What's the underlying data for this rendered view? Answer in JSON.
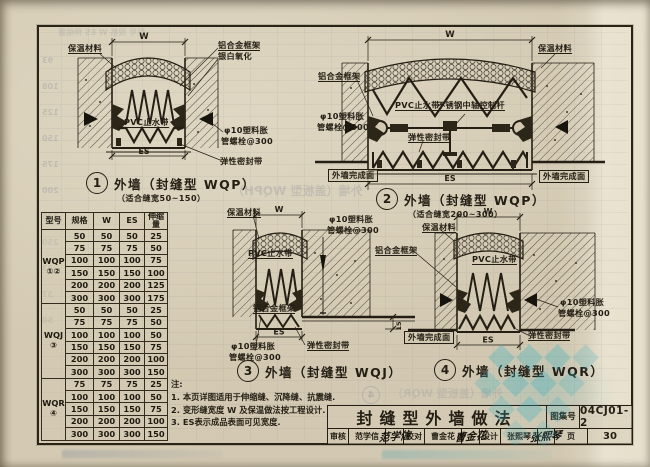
{
  "labels": {
    "insulation": "保温材料",
    "alu_frame": "铝合金框架",
    "anodized": "银白氧化",
    "pvc": "PVC止水带",
    "bolt1": "φ10塑料胀",
    "bolt2": "管螺栓@300",
    "seal": "弹性密封带",
    "rod": "不锈钢中轴控制杆",
    "finish": "外墙完成面",
    "w": "W",
    "es": "ES",
    "d15": "15"
  },
  "drawings": {
    "d1": {
      "num": "1",
      "title": "外墙（封缝型 WQP）",
      "sub": "（适合缝宽50~150）"
    },
    "d2": {
      "num": "2",
      "title": "外墙（封缝型 WQP）",
      "sub": "（适合缝宽200~300）"
    },
    "d3": {
      "num": "3",
      "title": "外墙（封缝型 WQJ）",
      "sub": ""
    },
    "d4": {
      "num": "4",
      "title": "外墙（封缝型 WQR）",
      "sub": ""
    }
  },
  "table": {
    "headers": [
      "型号",
      "规格",
      "W",
      "ES",
      "伸缩量"
    ],
    "groups": [
      {
        "model": "WQP",
        "marks": "①②",
        "rows": [
          [
            "50",
            "50",
            "50",
            "25"
          ],
          [
            "75",
            "75",
            "75",
            "50"
          ],
          [
            "100",
            "100",
            "100",
            "75"
          ],
          [
            "150",
            "150",
            "150",
            "100"
          ],
          [
            "200",
            "200",
            "200",
            "125"
          ],
          [
            "300",
            "300",
            "300",
            "175"
          ]
        ]
      },
      {
        "model": "WQJ",
        "marks": "③",
        "rows": [
          [
            "50",
            "50",
            "50",
            "25"
          ],
          [
            "75",
            "75",
            "75",
            "50"
          ],
          [
            "100",
            "100",
            "100",
            "50"
          ],
          [
            "150",
            "150",
            "150",
            "75"
          ],
          [
            "200",
            "200",
            "200",
            "100"
          ],
          [
            "300",
            "300",
            "300",
            "150"
          ]
        ]
      },
      {
        "model": "WQR",
        "marks": "④",
        "rows": [
          [
            "75",
            "75",
            "75",
            "25"
          ],
          [
            "100",
            "100",
            "100",
            "50"
          ],
          [
            "150",
            "150",
            "150",
            "75"
          ],
          [
            "200",
            "200",
            "200",
            "100"
          ],
          [
            "300",
            "300",
            "300",
            "150"
          ]
        ]
      }
    ]
  },
  "notes": {
    "head": "注:",
    "lines": [
      "1. 本页详图适用于伸缩缝、沉降缝、抗震缝.",
      "2. 变形缝宽度 W 及保温做法按工程设计.",
      "3. ES表示成品表面可见宽度."
    ]
  },
  "titleblock": {
    "title": "封缝型外墙做法",
    "atlas_label": "图集号",
    "atlas_no": "04CJ01-2",
    "page_label": "页",
    "page_no": "30",
    "cells": [
      {
        "label": "审核",
        "name": "范学信",
        "sig": "范学信"
      },
      {
        "label": "校对",
        "name": "曹金花",
        "sig": "曹金花"
      },
      {
        "label": "设计",
        "name": "张熙琴",
        "sig": "张熙琴"
      }
    ]
  },
  "ghosts": {
    "left_column": [
      "93",
      "108",
      "125",
      "150",
      "175",
      "200",
      "225",
      "250",
      "23",
      "37",
      "50"
    ],
    "top_row": "型号 规格 W ES 伸缩量",
    "mid_caption": "外墙（盖板型 WQPH）",
    "bottom_caption": "外墙（盖板型 WQR）",
    "circle_num": "4"
  }
}
